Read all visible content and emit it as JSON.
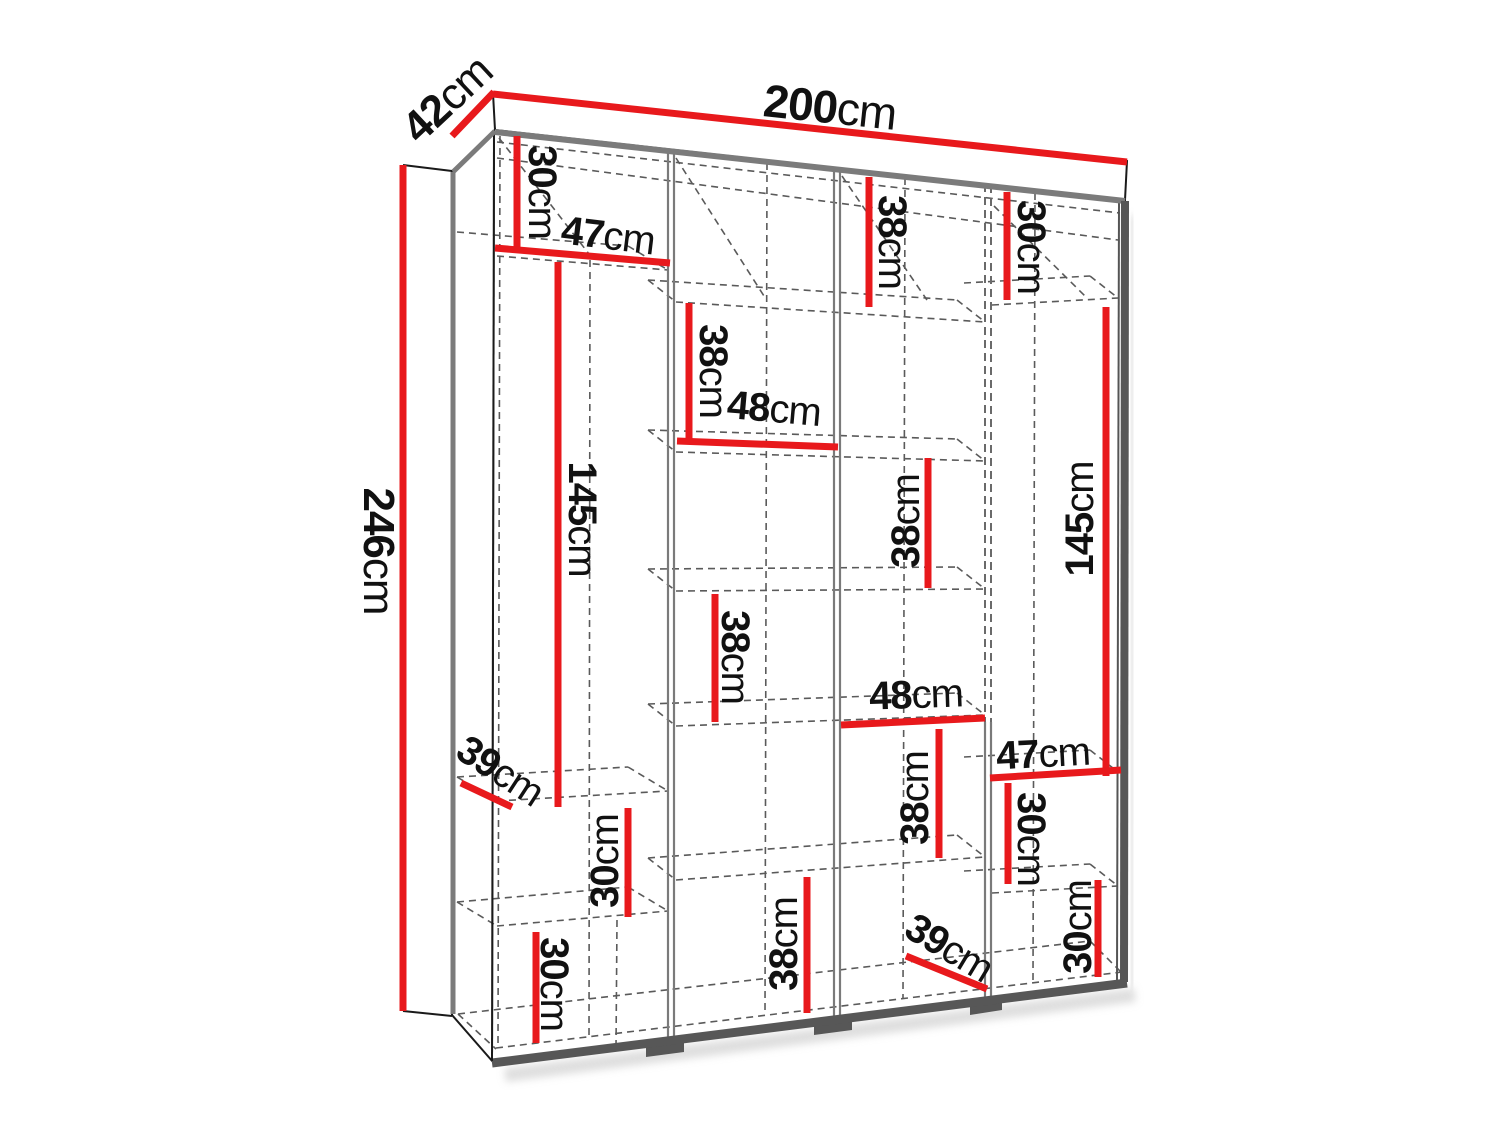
{
  "page": {
    "title": "Wardrobe interior dimension diagram",
    "background": "#ffffff"
  },
  "drawing": {
    "type": "furniture-dimension-diagram",
    "subject": "wardrobe with shelves, perspective view",
    "unit": "cm",
    "colors": {
      "dimension_line": "#e8191c",
      "edge_dark": "#575757",
      "edge_gray": "#7b7b7b",
      "hidden_line": "#5a5a5a",
      "text": "#111111"
    },
    "overall": {
      "width": {
        "value": "200",
        "unit": "cm"
      },
      "depth": {
        "value": "42",
        "unit": "cm"
      },
      "height": {
        "value": "246",
        "unit": "cm"
      }
    },
    "dimensions": [
      {
        "id": "overall-width",
        "value": "200",
        "unit": "cm"
      },
      {
        "id": "overall-depth",
        "value": "42",
        "unit": "cm"
      },
      {
        "id": "overall-height",
        "value": "246",
        "unit": "cm"
      },
      {
        "id": "col1-top-height",
        "value": "30",
        "unit": "cm"
      },
      {
        "id": "col1-width",
        "value": "47",
        "unit": "cm"
      },
      {
        "id": "col3-top-height",
        "value": "38",
        "unit": "cm"
      },
      {
        "id": "col4-top-height",
        "value": "30",
        "unit": "cm"
      },
      {
        "id": "col2-shelf-height-1",
        "value": "38",
        "unit": "cm"
      },
      {
        "id": "col2-width",
        "value": "48",
        "unit": "cm"
      },
      {
        "id": "col1-hanging-height",
        "value": "145",
        "unit": "cm"
      },
      {
        "id": "col3-shelf-height-2",
        "value": "38",
        "unit": "cm"
      },
      {
        "id": "col4-hanging-height",
        "value": "145",
        "unit": "cm"
      },
      {
        "id": "col2-shelf-height-2",
        "value": "38",
        "unit": "cm"
      },
      {
        "id": "col3-width",
        "value": "48",
        "unit": "cm"
      },
      {
        "id": "col4-width",
        "value": "47",
        "unit": "cm"
      },
      {
        "id": "col3-shelf-height-3",
        "value": "38",
        "unit": "cm"
      },
      {
        "id": "col4-shelf-height-1",
        "value": "30",
        "unit": "cm"
      },
      {
        "id": "col1-shelf-depth",
        "value": "39",
        "unit": "cm"
      },
      {
        "id": "col1-shelf-height-2",
        "value": "30",
        "unit": "cm"
      },
      {
        "id": "col2-bottom-height",
        "value": "38",
        "unit": "cm"
      },
      {
        "id": "col3-floor-depth",
        "value": "39",
        "unit": "cm"
      },
      {
        "id": "col4-bottom-height",
        "value": "30",
        "unit": "cm"
      },
      {
        "id": "col1-bottom-height",
        "value": "30",
        "unit": "cm"
      }
    ]
  }
}
